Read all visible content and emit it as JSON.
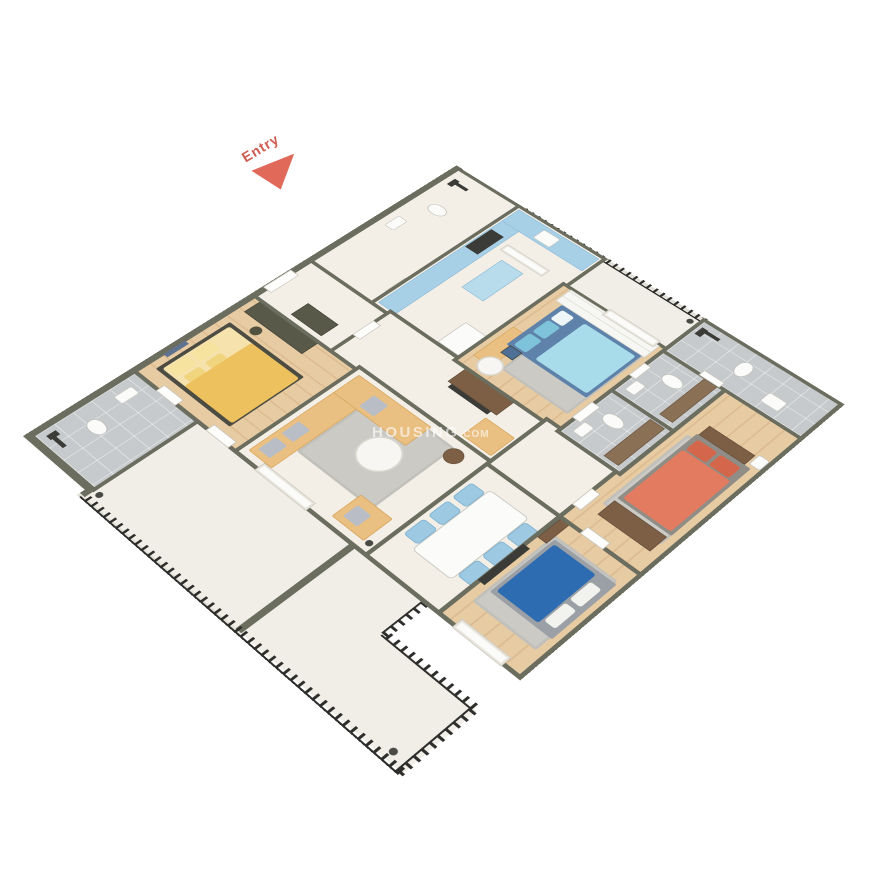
{
  "entry_label": "Entry",
  "watermark": {
    "name": "HOUSING",
    "suffix": ".COM"
  },
  "palette": {
    "background": "#ffffff",
    "wall_top": "#6b6d5f",
    "floor_cream": "#f4efe6",
    "floor_wood": "#e2c49c",
    "floor_tile_gray": "#c7cacc",
    "floor_balcony_marble": "#f1eee7",
    "railing_iron": "#2e2e2c",
    "sofa_tan": "#eabf82",
    "kitchen_cabinet_blue": "#a7d0e6",
    "dining_chair_blue": "#9dc9e2",
    "bed_yellow": "#edc25e",
    "bed_light_blue": "#a9dcea",
    "bed_dark_blue": "#2e6cb2",
    "bed_orange": "#e27b5f",
    "wood_furniture_brown": "#7d5f45",
    "wardrobe_dark": "#585949",
    "entry_arrow_red": "#e0695a",
    "entry_text_red": "#cf5a4e",
    "watermark_white": "rgba(255,255,255,0.62)"
  }
}
